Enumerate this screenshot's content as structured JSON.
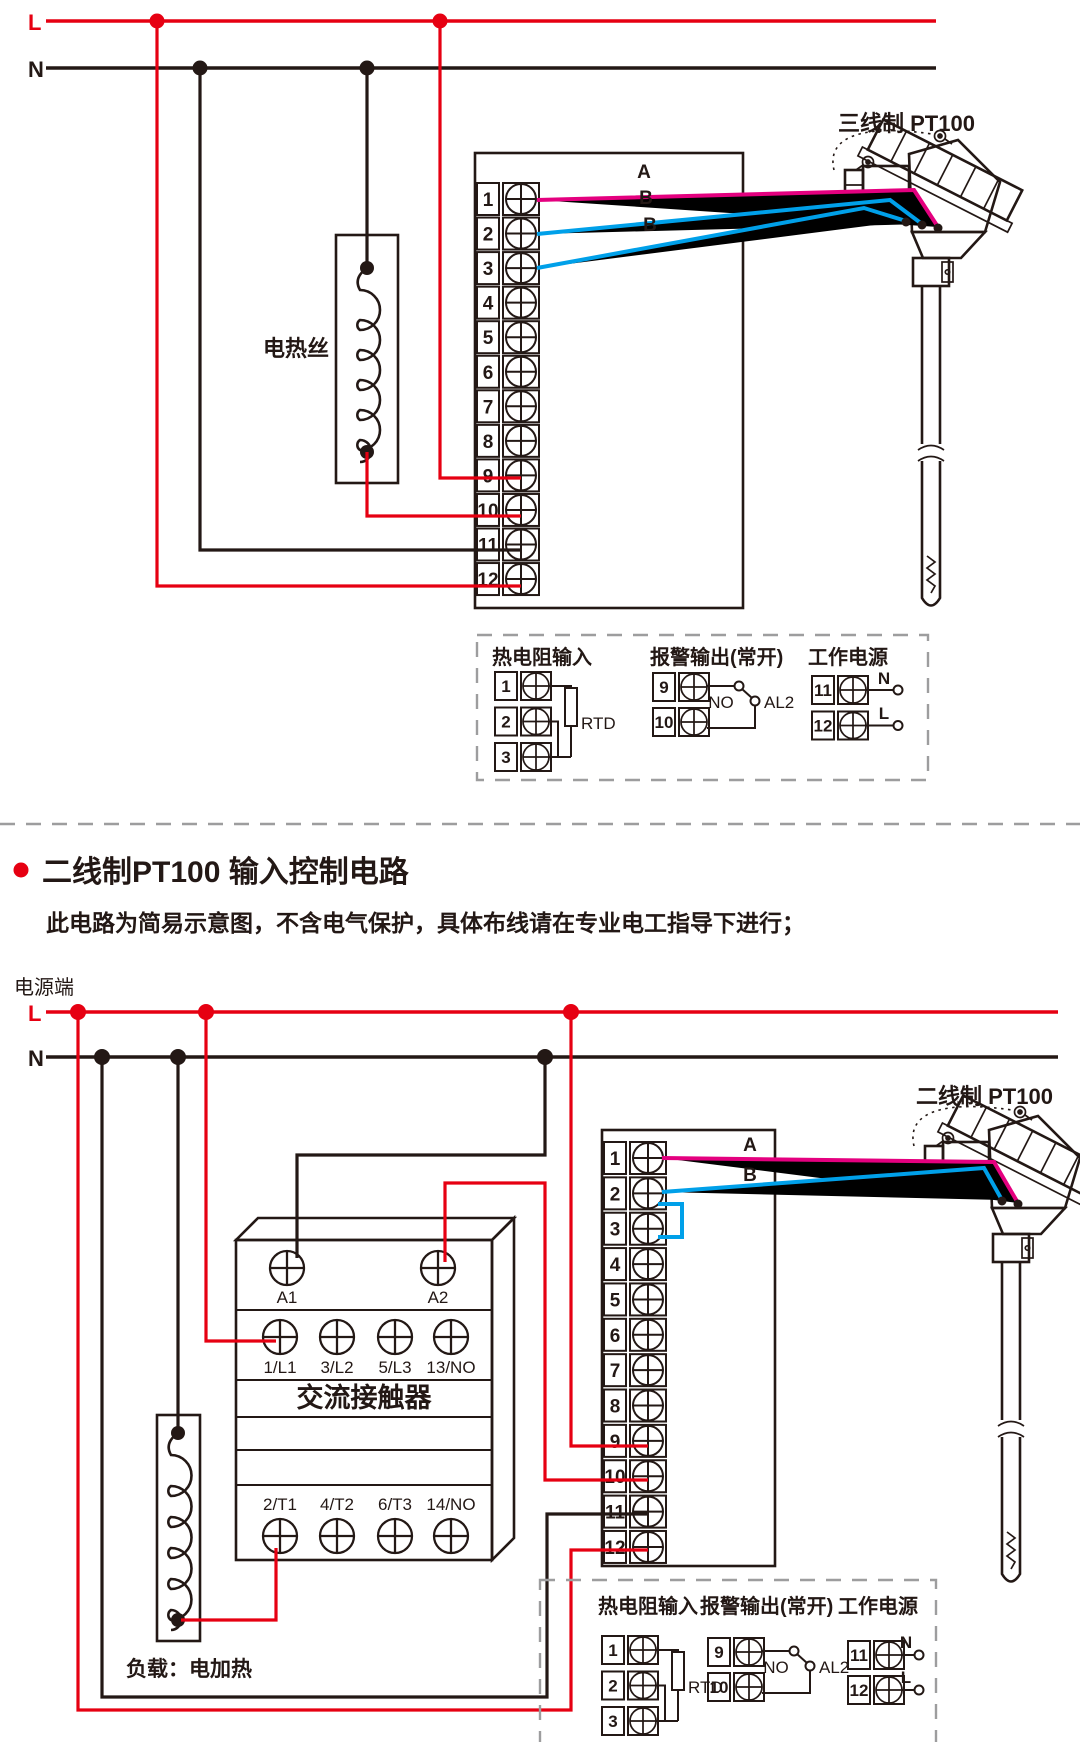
{
  "colors": {
    "red": "#e60012",
    "pink": "#e4007f",
    "blue": "#00a0e9",
    "ink": "#231815",
    "dash_gray": "#9d9d9e"
  },
  "top_circuit": {
    "l_label": "L",
    "n_label": "N",
    "heater_label": "电热丝",
    "sensor_label": "三线制 PT100",
    "wire_labels": {
      "a": "A",
      "b1": "B",
      "b2": "B"
    },
    "terminals": [
      "1",
      "2",
      "3",
      "4",
      "5",
      "6",
      "7",
      "8",
      "9",
      "10",
      "11",
      "12"
    ],
    "legend": {
      "rtd": {
        "title": "热电阻输入",
        "terminals": [
          "1",
          "2",
          "3"
        ],
        "resistor_label": "RTD"
      },
      "alarm": {
        "title": "报警输出(常开)",
        "terminals": [
          "9",
          "10"
        ],
        "contact_label": "NO",
        "output_label": "AL2"
      },
      "power": {
        "title": "工作电源",
        "terminals": [
          "11",
          "12"
        ],
        "n_label": "N",
        "l_label": "L"
      }
    }
  },
  "section_heading": {
    "title": "二线制PT100 输入控制电路",
    "subtitle": "此电路为简易示意图，不含电气保护，具体布线请在专业电工指导下进行；"
  },
  "bottom_circuit": {
    "power_terminal_label": "电源端",
    "l_label": "L",
    "n_label": "N",
    "sensor_label": "二线制 PT100",
    "wire_labels": {
      "a": "A",
      "b": "B"
    },
    "terminals": [
      "1",
      "2",
      "3",
      "4",
      "5",
      "6",
      "7",
      "8",
      "9",
      "10",
      "11",
      "12"
    ],
    "contactor": {
      "name": "交流接触器",
      "coil_terminals": [
        "A1",
        "A2"
      ],
      "line_terminals": [
        "1/L1",
        "3/L2",
        "5/L3",
        "13/NO"
      ],
      "load_terminals": [
        "2/T1",
        "4/T2",
        "6/T3",
        "14/NO"
      ]
    },
    "load_label": "负载：电加热",
    "legend": {
      "rtd": {
        "title": "热电阻输入",
        "terminals": [
          "1",
          "2",
          "3"
        ],
        "resistor_label": "RTD"
      },
      "alarm": {
        "title": "报警输出(常开)",
        "terminals": [
          "9",
          "10"
        ],
        "contact_label": "NO",
        "output_label": "AL2"
      },
      "power": {
        "title": "工作电源",
        "terminals": [
          "11",
          "12"
        ],
        "n_label": "N",
        "l_label": "L"
      }
    }
  }
}
